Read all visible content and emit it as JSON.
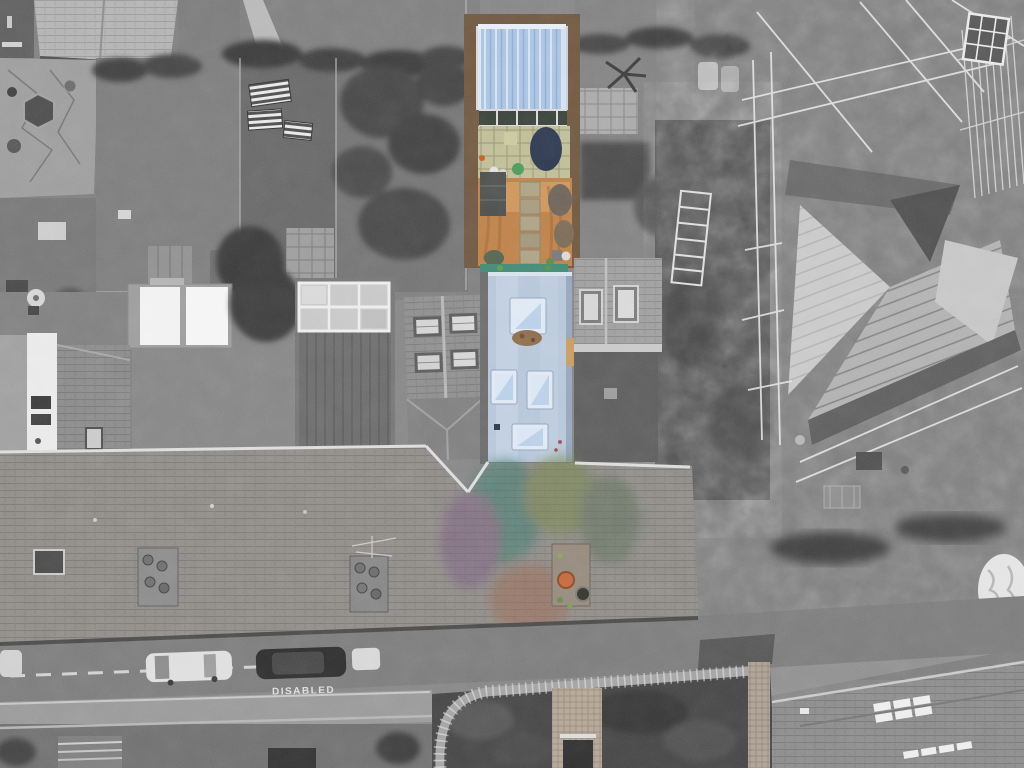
{
  "scene": {
    "type": "aerial-drone-photograph",
    "description": "Overhead view of a terraced property highlighted in colour against grayscale surroundings",
    "style": "selective-colour listing photo"
  },
  "road": {
    "marking_text": "DISABLED",
    "lane_line": "dashed-white"
  },
  "property": {
    "elements": [
      "garden room with pale blue corrugated roof",
      "paved patio with slabs",
      "orange gravel garden with stone path",
      "flat roof extension with four skylights",
      "chimney stack with terracotta pot"
    ]
  },
  "colors": {
    "garden_room_roof": "#a9c3e3",
    "garden_room_ridge": "#e7edf6",
    "garden_room_frame": "#6f5740",
    "glass_door_pane": "#39413b",
    "glass_door_frame": "#d9d9d9",
    "patio_slabs": "#bfbd95",
    "patio_grout": "#9a9877",
    "navy_cover": "#2e3950",
    "gravel": "#bd8049",
    "gravel_light": "#d49d64",
    "gravel_dark": "#9c6436",
    "stone_path": "#aca183",
    "shed_roof": "#4d4f4d",
    "teal_edge": "#3e8a74",
    "flat_roof": "#b6c5d9",
    "flat_roof_light": "#c8d5e5",
    "flat_roof_shadow": "#93a5bd",
    "skylight_frame": "#dfe8f3",
    "skylight_pane": "#b9cfe8",
    "skylight_sheen": "#eef4fb",
    "debris_patch": "#8a6a49",
    "tan_strip": "#c79a5f",
    "chimney_pot_orange": "#c4693a",
    "chimney_pot_dark": "#35342f",
    "tint_teal": "#3e7a6e",
    "tint_purple": "#7a5f80",
    "tint_moss": "#74844c",
    "tint_rust": "#9a6a55",
    "ground_gray": "#858585",
    "road_gray": "#7b7b7b",
    "roof_gray": "#8f8c88",
    "dark_vegetation": "#454545",
    "white_accent": "#ebebeb"
  }
}
